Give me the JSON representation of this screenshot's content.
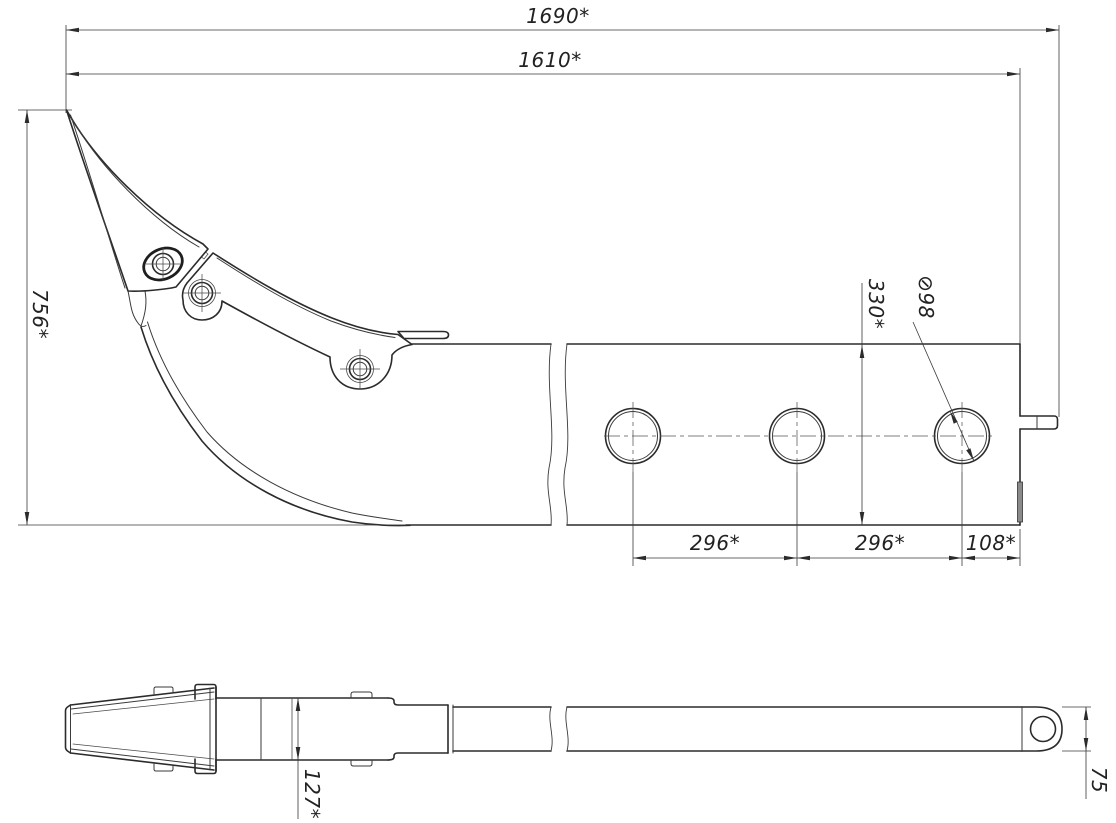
{
  "drawing": {
    "type": "engineering-drawing",
    "subject": "excavator ripper tooth attachment, two orthographic views (side view and plan view)",
    "units_note": "dimensions marked * are reference dimensions",
    "colors": {
      "line": "#2b2b2b",
      "background": "#ffffff",
      "insert_fill": "#8a8a8a"
    },
    "dimensions": {
      "overall_length": "1690*",
      "body_length": "1610*",
      "overall_height": "756*",
      "beam_section_height": "330*",
      "hole_diameter": "⊘98",
      "hole_pitch_1": "296*",
      "hole_pitch_2": "296*",
      "hole_end_offset": "108*",
      "shank_width": "127*",
      "eye_plate_height": "75"
    },
    "features": {
      "top_view": "side elevation: pointed ripper tooth, bolted adapter bracket with three bolts, curved shank blade, long rectangular beam with three ⊘98 holes and end tab",
      "bottom_view": "plan view: tapered tooth point, shank body with retainer clips, stepped transition, long flat bar ending in rounded eye plate with hole"
    }
  }
}
